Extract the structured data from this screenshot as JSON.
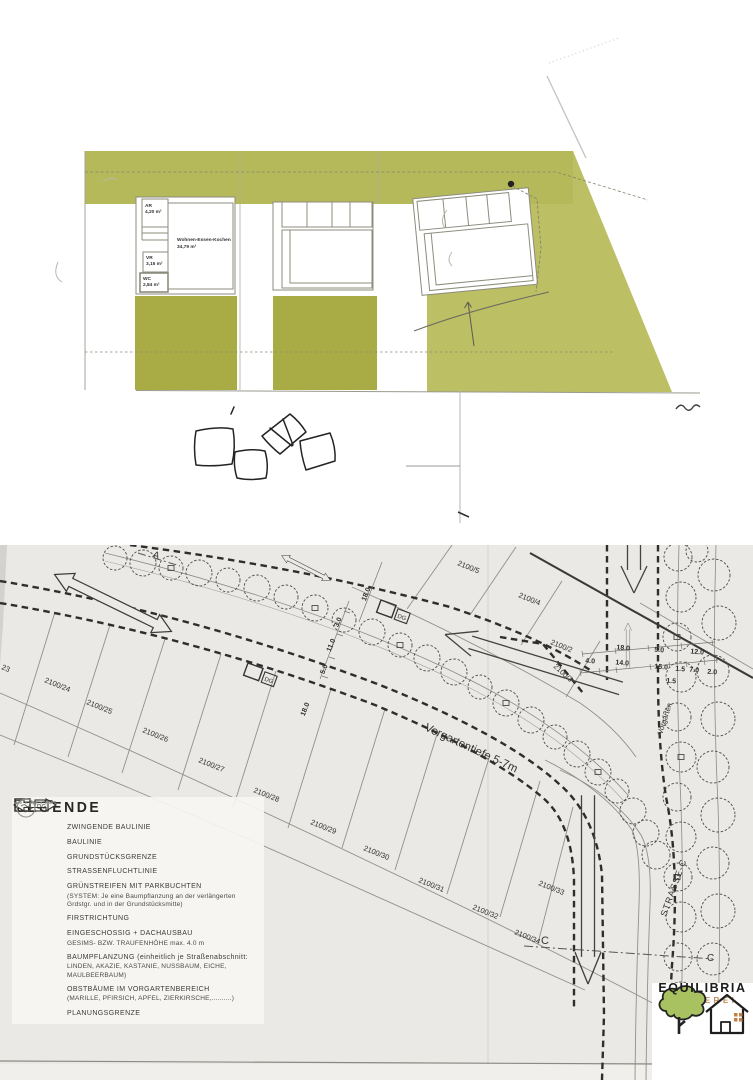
{
  "colors": {
    "olive_band": "#b6b95a",
    "olive_garden": "#a9ac45",
    "olive_right": "#bcbf63",
    "plan_paper": "#ebe9e6",
    "ink": "#3a3a3a",
    "logo_green": "#a8c262",
    "logo_orange": "#bf8a52"
  },
  "floor_plan": {
    "rooms": [
      {
        "name": "AR",
        "area": "4,20 m²"
      },
      {
        "name": "Wohnen-Essen-Kochen",
        "area": "34,79 m²"
      },
      {
        "name": "VR",
        "area": "3,15 m²"
      },
      {
        "name": "WC",
        "area": "2,84 m²"
      }
    ]
  },
  "site_plan": {
    "section_a": "A",
    "section_c": "C",
    "section_c_right": "C",
    "street": "STRASSE-C",
    "vorgarten": "Vorgarten",
    "vorgartentiefe": "Vorgartentiefe 5-7m",
    "dg": "DG",
    "parcels": [
      "23",
      "2100/24",
      "2100/25",
      "2100/26",
      "2100/27",
      "2100/28",
      "2100/29",
      "2100/30",
      "2100/31",
      "2100/32",
      "2100/33",
      "2100/34",
      "2100/5",
      "2100/4",
      "2100/2",
      "2100/3"
    ],
    "dims": [
      "18.0",
      "3.0",
      "11.0",
      "5.0",
      "18.0",
      "18.0",
      "5.0",
      "12.0",
      "4.0",
      "14.0",
      "15.0",
      "1.5",
      "7.0",
      "2.0",
      "1.5"
    ]
  },
  "legend": {
    "title": "LEGENDE",
    "items": [
      {
        "label": "ZWINGENDE BAULINIE"
      },
      {
        "label": "BAULINIE"
      },
      {
        "label": "GRUNDSTÜCKSGRENZE"
      },
      {
        "label": "STRASSENFLUCHTLINIE"
      },
      {
        "label": "GRÜNSTREIFEN MIT PARKBUCHTEN",
        "sub": "(SYSTEM: Je eine Baumpflanzung an der verlängerten Grdstgr. und in der Grundstücksmitte)"
      },
      {
        "label": "FIRSTRICHTUNG"
      },
      {
        "label": "EINGESCHOSSIG + DACHAUSBAU",
        "sub": "GESIMS- BZW. TRAUFENHÖHE max. 4.0 m"
      },
      {
        "label": "BAUMPFLANZUNG (einheitlich je Straßenabschnitt:",
        "sub": "LINDEN, AKAZIE, KASTANIE, NUSSBAUM, EICHE, MAULBEERBAUM)"
      },
      {
        "label": "OBSTBÄUME IM VORGARTENBEREICH",
        "sub": "(MARILLE, PFIRSICH, APFEL, ZIERKIRSCHE,..........)"
      },
      {
        "label": "PLANUNGSGRENZE"
      }
    ]
  },
  "logo": {
    "name": "EQUILIBRIA",
    "tagline": "MAKLEREI"
  }
}
